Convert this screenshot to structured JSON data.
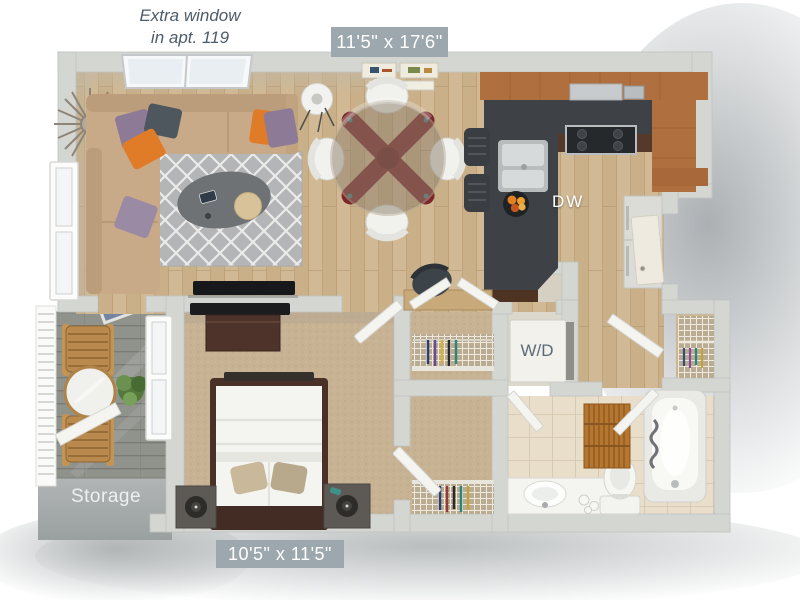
{
  "plan": {
    "annotation": {
      "line1": "Extra window",
      "line2": "in apt. 119"
    },
    "dimension_badges": {
      "living_dining": "11'5\" x 17'6\"",
      "bedroom": "10'5\" x 11'5\""
    },
    "labels": {
      "dishwasher": "DW",
      "washer_dryer": "W/D",
      "storage": "Storage"
    },
    "colors": {
      "badge_background": "#9ca7ae",
      "badge_text": "#ffffff",
      "annotation_text": "#4d5c69",
      "wd_label_text": "#5b6a76",
      "storage_label_text": "#edf0f0",
      "wall": "#d4d6d2",
      "wood_floor": "#cfb892",
      "bedroom_carpet": "#c7b294",
      "bathroom_tile": "#e8dec9",
      "balcony_deck": "#90928c",
      "storage_slab": "#a9aeae",
      "kitchen_counter": "#3e4247",
      "cabinet_wood": "#b06f3f",
      "sofa": "#c9aa88",
      "rug": "#b4b5b7",
      "accent_orange": "#e07b28",
      "accent_purple": "#8d7a96",
      "dining_table_base_red": "#7c272b"
    }
  }
}
